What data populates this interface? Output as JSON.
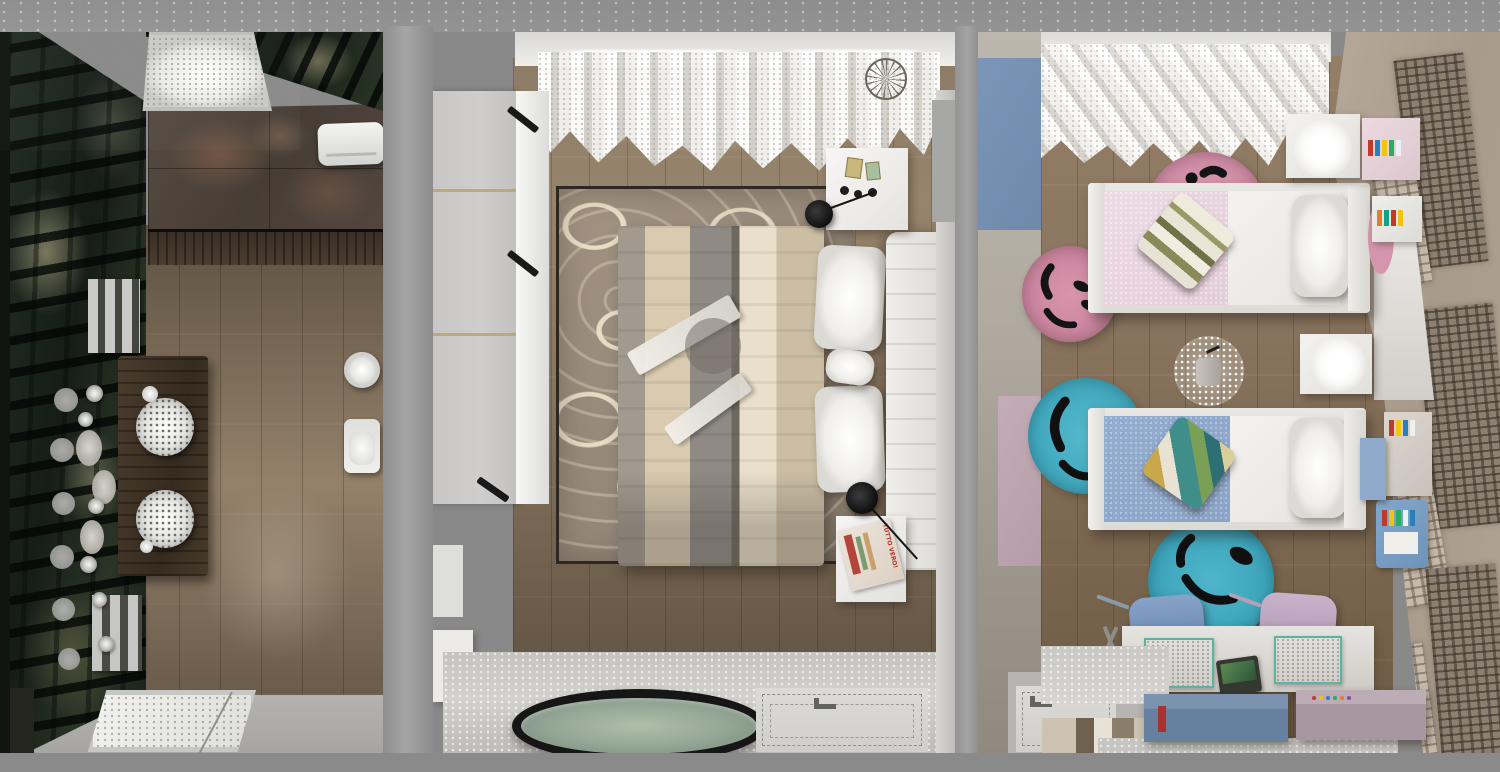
{
  "scene": {
    "title": "Top-down 3D render of a three-room apartment interior",
    "view": "bird's-eye cutaway floor plan, photorealistic render",
    "rooms": [
      {
        "name": "dining-room",
        "label": "Dining room with dark forest mural, skylight, marble wall, AC unit, wood dining table with crochet placemats and glasses, radiators, wall basin, toilet and shower tray",
        "items": [
          "forest-mural",
          "skylight",
          "marble-wall",
          "air-conditioner",
          "console-counter",
          "radiator",
          "dining-table",
          "crochet-placemats",
          "wine-glasses",
          "wall-plates",
          "wash-basin",
          "toilet",
          "tile-floor",
          "shower-tray"
        ]
      },
      {
        "name": "master-bedroom",
        "label": "Master bedroom with sheer curtains, white wardrobe with black handles, crackle-pattern rug, striped duvet double bed, tufted headboard, two nightstands with black arc lamps, wire pendant lamp, magazine, round sage tray table and white fluffy runner",
        "items": [
          "sheer-curtains",
          "wardrobe",
          "patterned-rug",
          "double-bed",
          "pillows",
          "tufted-headboard",
          "nightstand",
          "arc-lamp",
          "wire-pendant-lamp",
          "magazine",
          "round-tray-table",
          "fluffy-runner",
          "door"
        ]
      },
      {
        "name": "kids-room",
        "label": "Children's room with sheer curtains, blue and mauve wall panels, pink and blue smiley-face rugs, two single beds (pink and blue), wicker pendant lamp, glowing nightstand lamps, wall shelves with colorful books, blue book bin, study desk with open books, laptop, two chairs and drawer boxes, city-skyline mural wall",
        "items": [
          "sheer-curtains",
          "blue-wall-panel",
          "mauve-wall-panel",
          "smiley-rug-pink",
          "smiley-rug-blue",
          "single-bed-pink",
          "single-bed-blue",
          "striped-cushion",
          "multicolor-cushion",
          "wicker-pendant-lamp",
          "nightstand-lamp",
          "wall-shelf",
          "book-bin",
          "study-desk",
          "open-book",
          "laptop",
          "desk-chair",
          "drawer-box",
          "striped-rug",
          "door",
          "city-mural"
        ]
      }
    ]
  },
  "labels": {
    "magazine_title": "TUTTO VERO!"
  },
  "palette": {
    "wall-gray": "#898989",
    "divider": "#9d9d9d",
    "wood": "#85745f",
    "wood-deep": "#5e5140",
    "mural-dark": "#1b231d",
    "mural-light": "#c9bd93",
    "marble": "#4e443c",
    "gold": "#b8a468",
    "white-soft": "#f2f1ee",
    "beige": "#d9cab0",
    "gray-duvet": "#928c84",
    "sage": "#9cb09f",
    "pink-rug": "#d694ab",
    "blue-rug": "#49b0c6",
    "steel-blue": "#7590b2",
    "mauve": "#bfa7b1",
    "duvet-pink": "#ead8e1",
    "duvet-blue": "#8fa9cb",
    "city-base": "#b0a293",
    "city-building": "#8e8071"
  }
}
